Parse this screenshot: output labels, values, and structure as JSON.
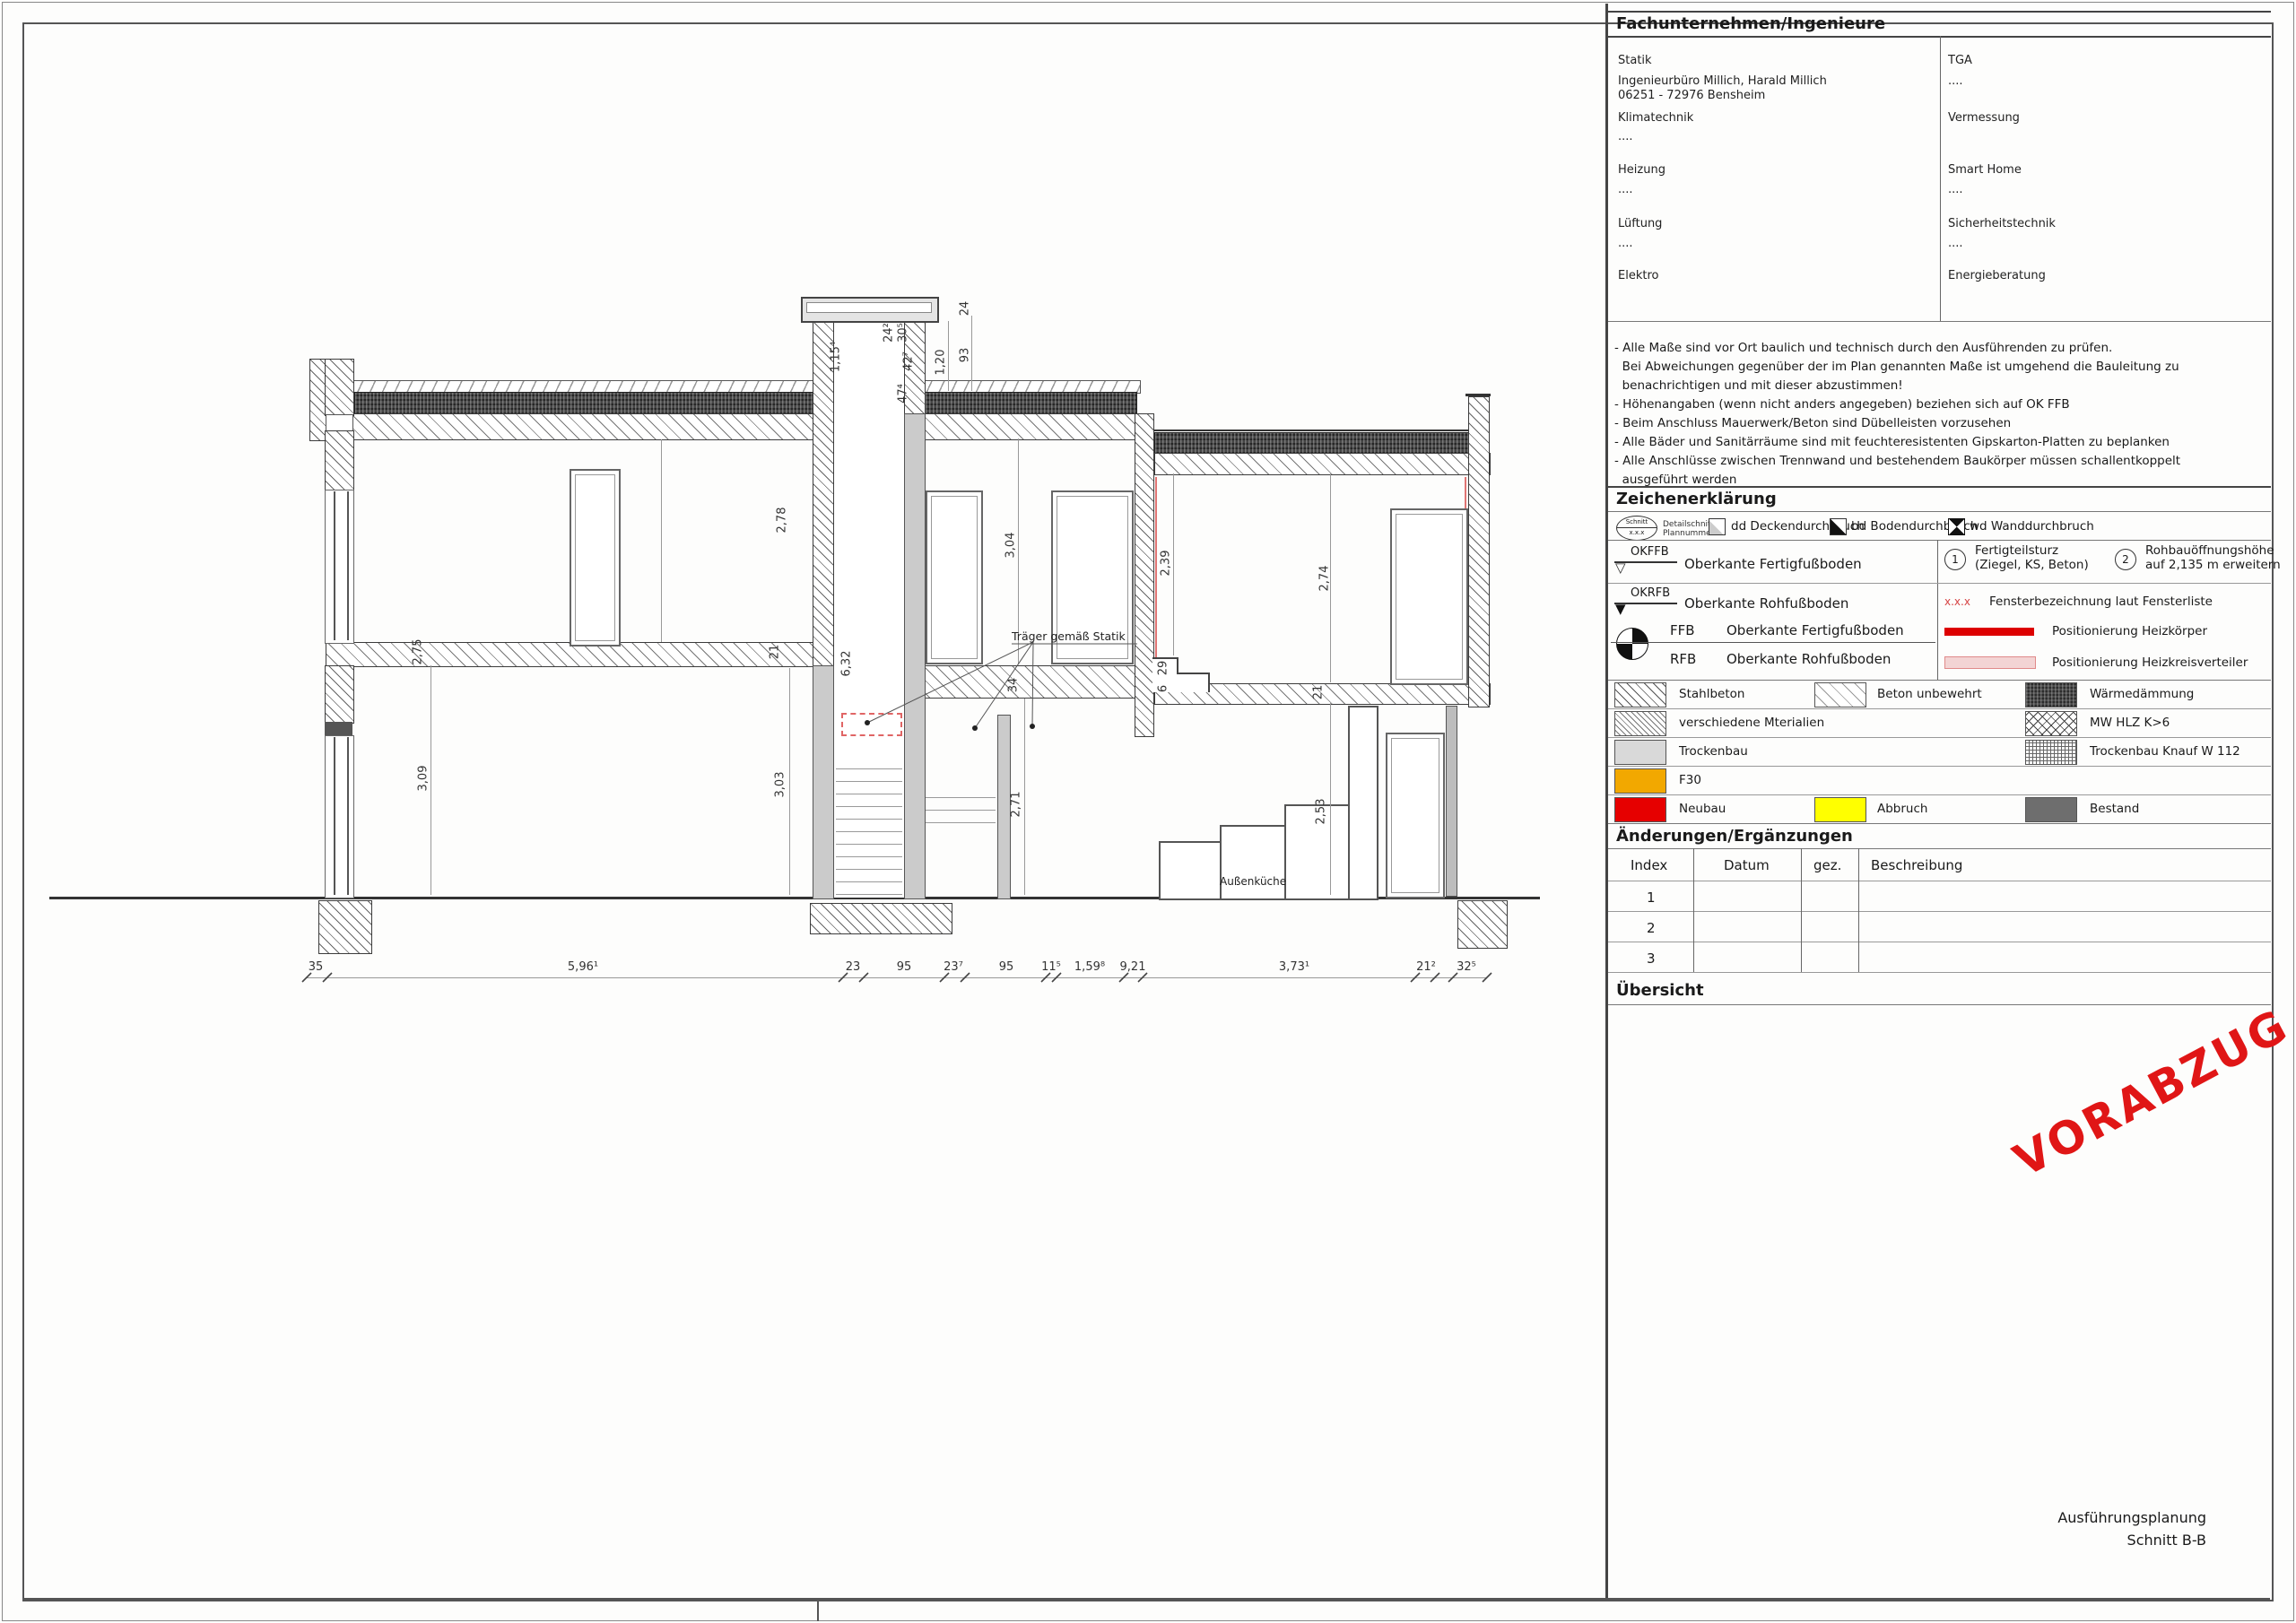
{
  "title_block": {
    "fachunternehmen": {
      "header": "Fachunternehmen/Ingenieure",
      "left": [
        {
          "label": "Statik",
          "value1": "Ingenieurbüro Millich, Harald Millich",
          "value2": "06251 - 72976 Bensheim"
        },
        {
          "label": "Klimatechnik",
          "value1": "....",
          "value2": ""
        },
        {
          "label": "Heizung",
          "value1": "....",
          "value2": ""
        },
        {
          "label": "Lüftung",
          "value1": "....",
          "value2": ""
        },
        {
          "label": "Elektro",
          "value1": "",
          "value2": ""
        }
      ],
      "right": [
        {
          "label": "TGA",
          "value1": "....",
          "value2": ""
        },
        {
          "label": "Vermessung",
          "value1": "",
          "value2": ""
        },
        {
          "label": "Smart Home",
          "value1": "....",
          "value2": ""
        },
        {
          "label": "Sicherheitstechnik",
          "value1": "....",
          "value2": ""
        },
        {
          "label": "Energieberatung",
          "value1": "",
          "value2": ""
        }
      ]
    },
    "notes": [
      "- Alle Maße sind vor Ort baulich und technisch durch den Ausführenden zu prüfen.",
      "  Bei Abweichungen gegenüber der im Plan genannten Maße ist umgehend die Bauleitung zu",
      "  benachrichtigen und mit dieser abzustimmen!",
      "- Höhenangaben (wenn nicht anders angegeben) beziehen sich auf OK FFB",
      "- Beim Anschluss Mauerwerk/Beton sind Dübelleisten vorzusehen",
      "- Alle Bäder und Sanitärräume sind mit feuchteresistenten Gipskarton-Platten zu beplanken",
      "- Alle Anschlüsse zwischen Trennwand und bestehendem Baukörper müssen schallentkoppelt",
      "  ausgeführt werden"
    ],
    "zeichenerklaerung": {
      "header": "Zeichenerklärung",
      "detail_symbol": {
        "top": "Schnitt",
        "bottom": "x.x.x",
        "label1": "Detailschnitt",
        "label2": "Plannummer"
      },
      "durchbrueche": [
        "dd Deckendurchbruch",
        "bd Bodendurchbruch",
        "wd Wanddurchbruch"
      ],
      "okffb_abbr": "OKFFB",
      "okffb_label": "Oberkante Fertigfußboden",
      "okrfb_abbr": "OKRFB",
      "okrfb_label": "Oberkante Rohfußboden",
      "ffb_abbr": "FFB",
      "ffb_label": "Oberkante Fertigfußboden",
      "rfb_abbr": "RFB",
      "rfb_label": "Oberkante Rohfußboden",
      "sturz_num": "1",
      "sturz_line1": "Fertigteilsturz",
      "sturz_line2": "(Ziegel, KS, Beton)",
      "rohbau_num": "2",
      "rohbau_line1": "Rohbauöffnungshöhe",
      "rohbau_line2": "auf 2,135 m erweitern",
      "fenster_mark": "x.x.x",
      "fenster_label": "Fensterbezeichnung laut Fensterliste",
      "heizkoerper_label": "Positionierung Heizkörper",
      "heizkreis_label": "Positionierung Heizkreisverteiler",
      "materials": [
        "Stahlbeton",
        "Beton unbewehrt",
        "Wärmedämmung",
        "verschiedene Mterialien",
        "MW HLZ K>6",
        "Trockenbau",
        "Trockenbau Knauf W 112",
        "F30",
        "Neubau",
        "Abbruch",
        "Bestand"
      ],
      "colors": {
        "f30": "#f2a800",
        "neubau": "#e60000",
        "abbruch": "#ffff00",
        "bestand": "#6e6e6e",
        "heizkoerper": "#dd0000",
        "heizkreis_fill": "#f3d4d4",
        "fenster_mark": "#d64545"
      }
    },
    "aenderungen": {
      "header": "Änderungen/Ergänzungen",
      "columns": [
        "Index",
        "Datum",
        "gez.",
        "Beschreibung"
      ],
      "rows": [
        "1",
        "2",
        "3"
      ]
    },
    "uebersicht_header": "Übersicht",
    "stamp": {
      "text": "VORABZUG",
      "color": "#e01616"
    },
    "plan_title": {
      "line1": "Ausführungsplanung",
      "line2": "Schnitt B-B"
    }
  },
  "drawing": {
    "beam_note": "Träger gemäß Statik",
    "outdoor_kitchen": "Außenküche",
    "dims": [
      "2,78",
      "3,04",
      "2,39",
      "2,74",
      "3,09",
      "3,03",
      "2,71",
      "2,53",
      "2,75",
      "21",
      "6,32",
      "34",
      "21",
      "29",
      "6",
      "1,15⁴",
      "24²",
      "30⁵",
      "42⁷",
      "47⁴",
      "1,20",
      "93",
      "24"
    ],
    "chain": [
      "35",
      "5,96¹",
      "23",
      "95",
      "23⁷",
      "95",
      "11⁵",
      "1,59⁸",
      "9,21",
      "3,73¹",
      "21²",
      "32⁵"
    ]
  }
}
